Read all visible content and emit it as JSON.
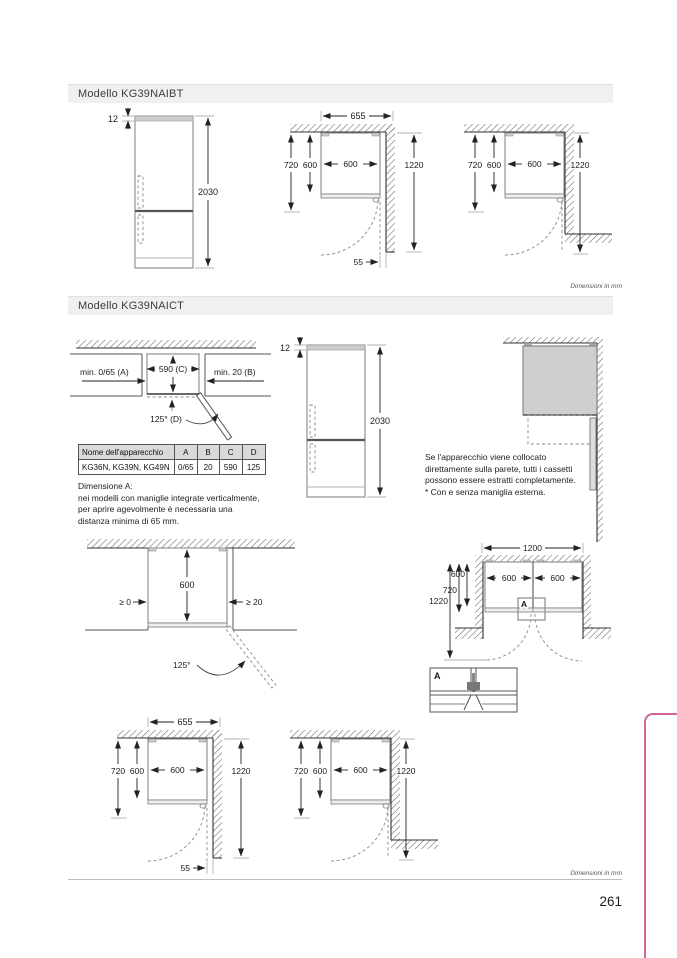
{
  "page": {
    "number": "261",
    "accent_pink": "#d2659c"
  },
  "s1": {
    "title": "Modello KG39NAIBT",
    "units_note": "Dimensioni in mm",
    "front": {
      "gap": "12",
      "height": "2030"
    },
    "corner": {
      "total": "655",
      "wall_depth": "720",
      "body_depth": "600",
      "body_width": "600",
      "clearance": "1220",
      "side_gap": "55"
    },
    "recess": {
      "wall_depth": "720",
      "body_depth": "600",
      "body_width": "600",
      "clearance": "1220"
    }
  },
  "s2": {
    "title": "Modello KG39NAICT",
    "units_note": "Dimensioni in mm",
    "niche": {
      "left": "min. 0/65 (A)",
      "width": "590 (C)",
      "right": "min. 20 (B)",
      "angle": "125° (D)"
    },
    "table": {
      "headers": [
        "Nome dell'apparecchio",
        "A",
        "B",
        "C",
        "D"
      ],
      "row": [
        "KG36N, KG39N, KG49N",
        "0/65",
        "20",
        "590",
        "125"
      ]
    },
    "note": {
      "l1": "Dimensione A:",
      "l2": "nei modelli con maniglie integrate verticalmente,",
      "l3": "per aprire agevolmente è necessaria una",
      "l4": "distanza minima di 65 mm."
    },
    "front": {
      "gap": "12",
      "height": "2030"
    },
    "wallnote": {
      "l1": "Se l'apparecchio viene collocato",
      "l2": "direttamente sulla parete, tutti i cassetti",
      "l3": "possono essere estratti completamente.",
      "l4": "* Con e senza maniglia esterna."
    },
    "open": {
      "depth": "600",
      "left_gap": "≥ 0",
      "right_gap": "≥ 20",
      "angle": "125°"
    },
    "pair": {
      "total": "1200",
      "body_depth": "600",
      "wall_depth": "720",
      "clearance": "1220",
      "left_width": "600",
      "right_width": "600",
      "detail": "A"
    },
    "detail": {
      "label": "A"
    },
    "corner": {
      "total": "655",
      "wall_depth": "720",
      "body_depth": "600",
      "body_width": "600",
      "clearance": "1220",
      "side_gap": "55"
    },
    "recess": {
      "wall_depth": "720",
      "body_depth": "600",
      "body_width": "600",
      "clearance": "1220"
    }
  }
}
